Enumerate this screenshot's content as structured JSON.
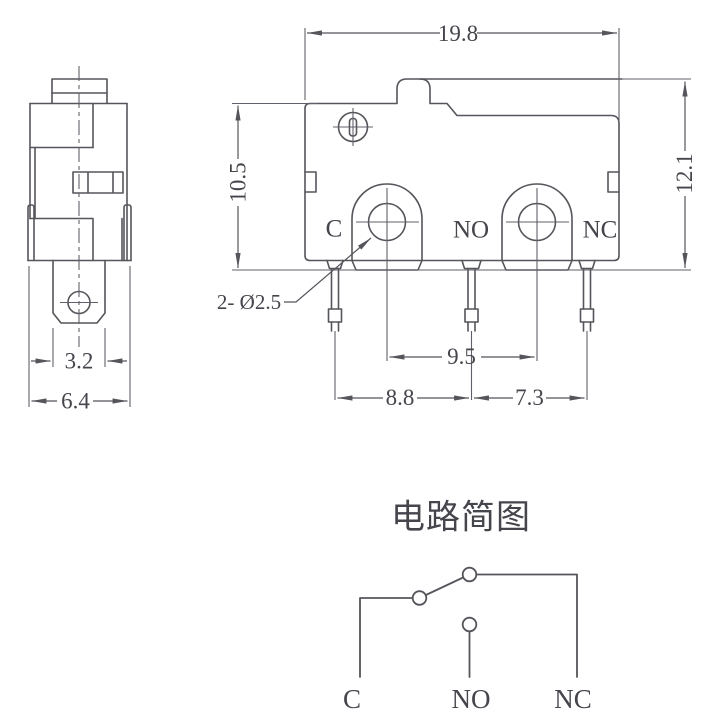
{
  "front_view": {
    "dim_width": "19.8",
    "dim_height_left": "10.5",
    "dim_height_right": "12.1",
    "dim_hole_spacing": "9.5",
    "dim_pin_spacing_left": "8.8",
    "dim_pin_spacing_right": "7.3",
    "hole_callout": "2- Ø2.5",
    "terminal_common": "C",
    "terminal_normally_open": "NO",
    "terminal_normally_closed": "NC"
  },
  "side_view": {
    "dim_terminal_width": "3.2",
    "dim_body_depth": "6.4"
  },
  "circuit": {
    "title": "电路简图",
    "label_common": "C",
    "label_normally_open": "NO",
    "label_normally_closed": "NC"
  },
  "colors": {
    "line": "#55555b",
    "text": "#45454c",
    "background": "#ffffff"
  }
}
